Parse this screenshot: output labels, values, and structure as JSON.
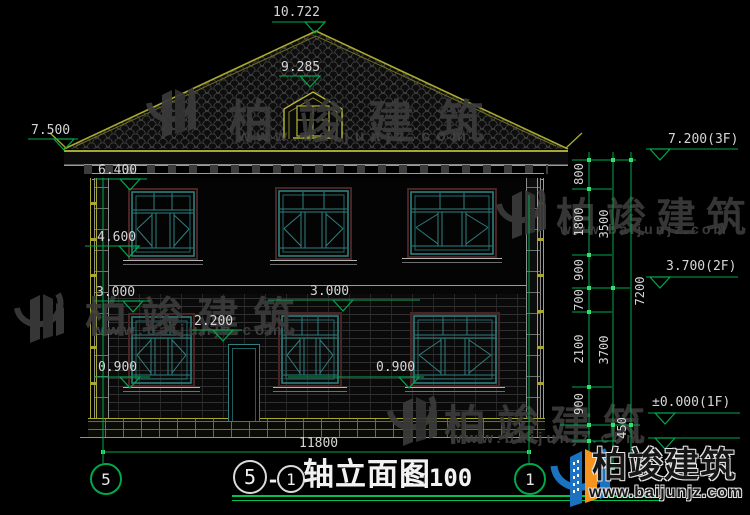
{
  "title_block": {
    "axis_left": "5",
    "separator": "-",
    "axis_right": "1",
    "name": "轴立面图",
    "scale": "1:100"
  },
  "axis_bubbles": {
    "left": "5",
    "right": "1"
  },
  "annotations": {
    "levels": [
      "10.722",
      "9.285",
      "7.500",
      "6.400",
      "4.600",
      "3.000",
      "3.000",
      "2.200",
      "0.900",
      "0.900",
      "7.200(3F)",
      "3.700(2F)",
      "±0.000(1F)"
    ],
    "dims_right": [
      "800",
      "1800",
      "900",
      "700",
      "2100",
      "900",
      "450",
      "3500",
      "3700",
      "7200"
    ],
    "width_dim": "11800"
  },
  "watermark": {
    "text": "柏竣建筑",
    "site": "www.baijunjz.com"
  },
  "brand": {
    "name": "柏竣建筑",
    "site": "www.baijunjz.com"
  },
  "colors": {
    "dimension_green": "#00a84a",
    "tick_green": "#35e06a",
    "outline_yellow": "#a8a830",
    "window_teal": "#2e7f7f",
    "text_gray": "#d6d6d6",
    "brand_blue": "#1a72c0",
    "brand_orange": "#f7941d"
  }
}
